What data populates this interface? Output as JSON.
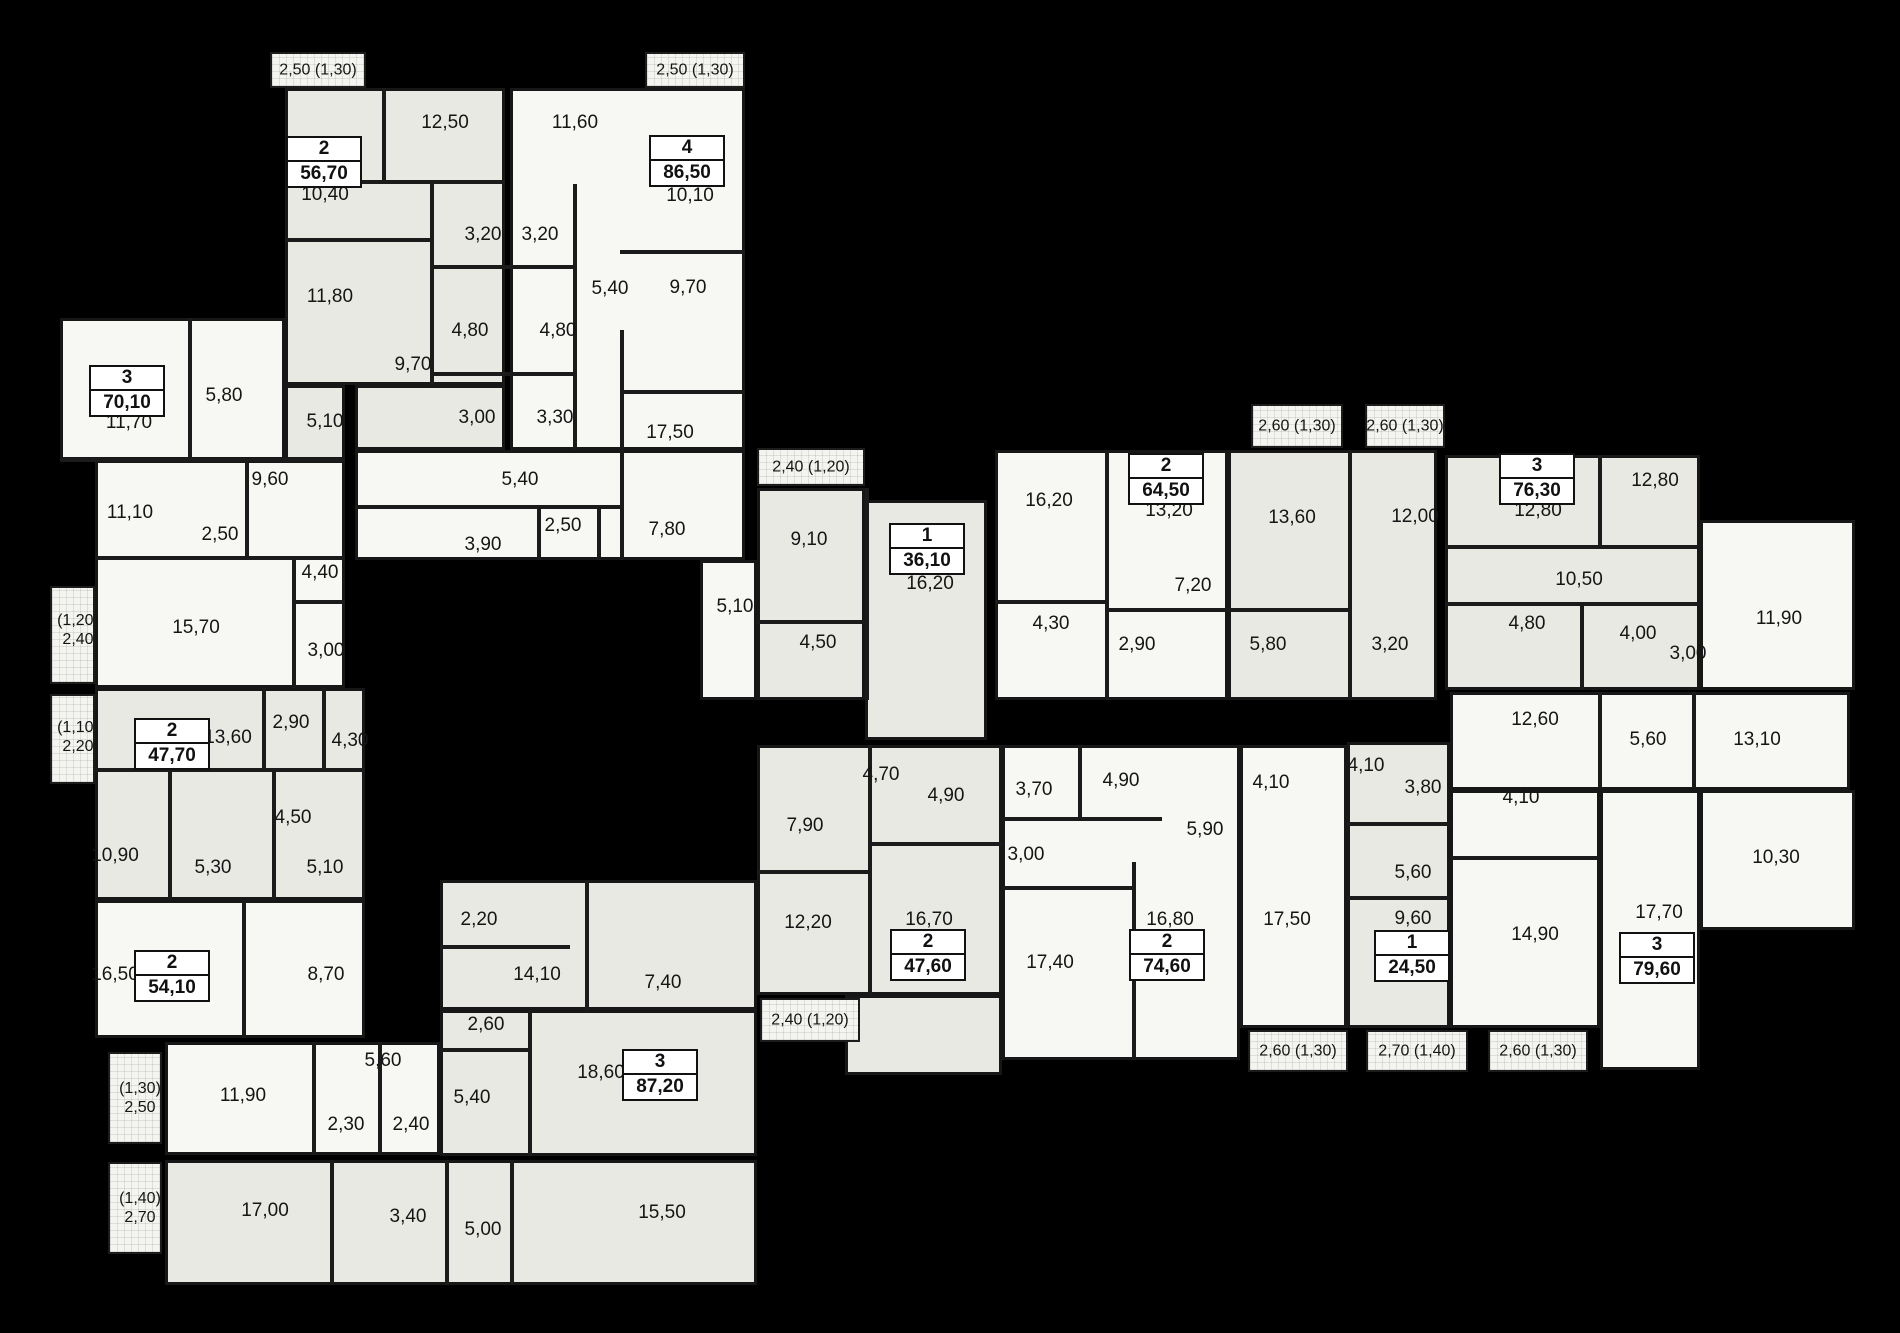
{
  "plan": {
    "background": "#000000",
    "wall_color": "#1b1b1b",
    "tones": {
      "g": "#e9e9e3",
      "w": "#f7f7f3"
    },
    "blocks": [
      {
        "x": 285,
        "y": 88,
        "w": 220,
        "h": 297,
        "t": "g"
      },
      {
        "x": 355,
        "y": 385,
        "w": 150,
        "h": 65,
        "t": "g"
      },
      {
        "x": 510,
        "y": 88,
        "w": 235,
        "h": 362,
        "t": "w"
      },
      {
        "x": 355,
        "y": 450,
        "w": 390,
        "h": 110,
        "t": "w"
      },
      {
        "x": 60,
        "y": 318,
        "w": 225,
        "h": 142,
        "t": "w"
      },
      {
        "x": 285,
        "y": 385,
        "w": 60,
        "h": 75,
        "t": "g"
      },
      {
        "x": 95,
        "y": 460,
        "w": 250,
        "h": 228,
        "t": "w"
      },
      {
        "x": 757,
        "y": 488,
        "w": 108,
        "h": 212,
        "t": "g"
      },
      {
        "x": 865,
        "y": 500,
        "w": 122,
        "h": 240,
        "t": "g"
      },
      {
        "x": 700,
        "y": 560,
        "w": 57,
        "h": 140,
        "t": "w"
      },
      {
        "x": 995,
        "y": 450,
        "w": 233,
        "h": 250,
        "t": "w"
      },
      {
        "x": 1228,
        "y": 450,
        "w": 209,
        "h": 250,
        "t": "g"
      },
      {
        "x": 1445,
        "y": 455,
        "w": 255,
        "h": 235,
        "t": "g"
      },
      {
        "x": 1700,
        "y": 520,
        "w": 155,
        "h": 170,
        "t": "w"
      },
      {
        "x": 1450,
        "y": 692,
        "w": 400,
        "h": 98,
        "t": "w"
      },
      {
        "x": 1450,
        "y": 790,
        "w": 150,
        "h": 238,
        "t": "w"
      },
      {
        "x": 1600,
        "y": 790,
        "w": 100,
        "h": 280,
        "t": "w"
      },
      {
        "x": 1700,
        "y": 790,
        "w": 155,
        "h": 140,
        "t": "w"
      },
      {
        "x": 1347,
        "y": 742,
        "w": 103,
        "h": 286,
        "t": "g"
      },
      {
        "x": 1002,
        "y": 745,
        "w": 238,
        "h": 315,
        "t": "w"
      },
      {
        "x": 1240,
        "y": 745,
        "w": 107,
        "h": 283,
        "t": "w"
      },
      {
        "x": 757,
        "y": 745,
        "w": 245,
        "h": 250,
        "t": "g"
      },
      {
        "x": 845,
        "y": 995,
        "w": 157,
        "h": 80,
        "t": "g"
      },
      {
        "x": 95,
        "y": 688,
        "w": 270,
        "h": 212,
        "t": "g"
      },
      {
        "x": 95,
        "y": 900,
        "w": 270,
        "h": 138,
        "t": "w"
      },
      {
        "x": 165,
        "y": 1042,
        "w": 275,
        "h": 113,
        "t": "w"
      },
      {
        "x": 165,
        "y": 1160,
        "w": 592,
        "h": 125,
        "t": "g"
      },
      {
        "x": 440,
        "y": 880,
        "w": 317,
        "h": 130,
        "t": "g"
      },
      {
        "x": 440,
        "y": 1010,
        "w": 317,
        "h": 146,
        "t": "g"
      }
    ],
    "walls": [
      {
        "x": 382,
        "y": 88,
        "w": 4,
        "h": 94
      },
      {
        "x": 285,
        "y": 238,
        "w": 145,
        "h": 4
      },
      {
        "x": 355,
        "y": 180,
        "w": 150,
        "h": 4
      },
      {
        "x": 430,
        "y": 184,
        "w": 4,
        "h": 201
      },
      {
        "x": 430,
        "y": 265,
        "w": 143,
        "h": 4
      },
      {
        "x": 430,
        "y": 372,
        "w": 143,
        "h": 4
      },
      {
        "x": 573,
        "y": 184,
        "w": 4,
        "h": 266
      },
      {
        "x": 620,
        "y": 250,
        "w": 125,
        "h": 4
      },
      {
        "x": 620,
        "y": 390,
        "w": 125,
        "h": 4
      },
      {
        "x": 620,
        "y": 330,
        "w": 4,
        "h": 230
      },
      {
        "x": 355,
        "y": 505,
        "w": 265,
        "h": 4
      },
      {
        "x": 537,
        "y": 505,
        "w": 4,
        "h": 55
      },
      {
        "x": 597,
        "y": 505,
        "w": 4,
        "h": 55
      },
      {
        "x": 188,
        "y": 318,
        "w": 4,
        "h": 140
      },
      {
        "x": 60,
        "y": 458,
        "w": 285,
        "h": 4
      },
      {
        "x": 95,
        "y": 556,
        "w": 250,
        "h": 4
      },
      {
        "x": 245,
        "y": 460,
        "w": 4,
        "h": 98
      },
      {
        "x": 292,
        "y": 558,
        "w": 4,
        "h": 130
      },
      {
        "x": 292,
        "y": 600,
        "w": 53,
        "h": 4
      },
      {
        "x": 865,
        "y": 488,
        "w": 4,
        "h": 212
      },
      {
        "x": 757,
        "y": 620,
        "w": 108,
        "h": 4
      },
      {
        "x": 1105,
        "y": 450,
        "w": 4,
        "h": 152
      },
      {
        "x": 1348,
        "y": 450,
        "w": 4,
        "h": 250
      },
      {
        "x": 995,
        "y": 600,
        "w": 113,
        "h": 4
      },
      {
        "x": 1105,
        "y": 608,
        "w": 127,
        "h": 4
      },
      {
        "x": 1232,
        "y": 608,
        "w": 120,
        "h": 4
      },
      {
        "x": 1105,
        "y": 600,
        "w": 4,
        "h": 100
      },
      {
        "x": 1598,
        "y": 455,
        "w": 4,
        "h": 92
      },
      {
        "x": 1445,
        "y": 545,
        "w": 255,
        "h": 4
      },
      {
        "x": 1445,
        "y": 602,
        "w": 255,
        "h": 4
      },
      {
        "x": 1580,
        "y": 606,
        "w": 4,
        "h": 84
      },
      {
        "x": 1598,
        "y": 692,
        "w": 4,
        "h": 96
      },
      {
        "x": 1692,
        "y": 692,
        "w": 4,
        "h": 96
      },
      {
        "x": 1450,
        "y": 856,
        "w": 150,
        "h": 4
      },
      {
        "x": 1347,
        "y": 822,
        "w": 103,
        "h": 4
      },
      {
        "x": 1347,
        "y": 896,
        "w": 103,
        "h": 4
      },
      {
        "x": 1078,
        "y": 745,
        "w": 4,
        "h": 74
      },
      {
        "x": 1002,
        "y": 817,
        "w": 160,
        "h": 4
      },
      {
        "x": 1002,
        "y": 886,
        "w": 130,
        "h": 4
      },
      {
        "x": 1132,
        "y": 862,
        "w": 4,
        "h": 198
      },
      {
        "x": 868,
        "y": 745,
        "w": 4,
        "h": 250
      },
      {
        "x": 757,
        "y": 870,
        "w": 113,
        "h": 4
      },
      {
        "x": 870,
        "y": 842,
        "w": 132,
        "h": 4
      },
      {
        "x": 95,
        "y": 768,
        "w": 270,
        "h": 4
      },
      {
        "x": 262,
        "y": 688,
        "w": 4,
        "h": 82
      },
      {
        "x": 322,
        "y": 688,
        "w": 4,
        "h": 82
      },
      {
        "x": 168,
        "y": 770,
        "w": 4,
        "h": 130
      },
      {
        "x": 272,
        "y": 770,
        "w": 4,
        "h": 130
      },
      {
        "x": 242,
        "y": 900,
        "w": 4,
        "h": 138
      },
      {
        "x": 312,
        "y": 1042,
        "w": 4,
        "h": 113
      },
      {
        "x": 378,
        "y": 1042,
        "w": 4,
        "h": 113
      },
      {
        "x": 330,
        "y": 1160,
        "w": 4,
        "h": 125
      },
      {
        "x": 445,
        "y": 1160,
        "w": 4,
        "h": 125
      },
      {
        "x": 510,
        "y": 1160,
        "w": 4,
        "h": 125
      },
      {
        "x": 440,
        "y": 945,
        "w": 130,
        "h": 4
      },
      {
        "x": 585,
        "y": 880,
        "w": 4,
        "h": 132
      },
      {
        "x": 528,
        "y": 1010,
        "w": 4,
        "h": 146
      },
      {
        "x": 440,
        "y": 1048,
        "w": 90,
        "h": 4
      }
    ],
    "balconies": [
      {
        "x": 270,
        "y": 52,
        "w": 96,
        "h": 36
      },
      {
        "x": 645,
        "y": 52,
        "w": 100,
        "h": 36
      },
      {
        "x": 757,
        "y": 448,
        "w": 108,
        "h": 38
      },
      {
        "x": 1251,
        "y": 404,
        "w": 92,
        "h": 44
      },
      {
        "x": 1365,
        "y": 404,
        "w": 80,
        "h": 44
      },
      {
        "x": 50,
        "y": 586,
        "w": 45,
        "h": 98
      },
      {
        "x": 50,
        "y": 694,
        "w": 45,
        "h": 90
      },
      {
        "x": 760,
        "y": 998,
        "w": 100,
        "h": 44
      },
      {
        "x": 1248,
        "y": 1030,
        "w": 100,
        "h": 42
      },
      {
        "x": 1366,
        "y": 1030,
        "w": 102,
        "h": 42
      },
      {
        "x": 1488,
        "y": 1030,
        "w": 100,
        "h": 42
      },
      {
        "x": 108,
        "y": 1052,
        "w": 54,
        "h": 92
      },
      {
        "x": 108,
        "y": 1162,
        "w": 54,
        "h": 92
      }
    ],
    "balcony_labels": [
      {
        "t": "2,50 (1,30)",
        "x": 318,
        "y": 70
      },
      {
        "t": "2,50 (1,30)",
        "x": 695,
        "y": 70
      },
      {
        "t": "2,40 (1,20)",
        "x": 811,
        "y": 467
      },
      {
        "t": "2,60 (1,30)",
        "x": 1297,
        "y": 426
      },
      {
        "t": "2,60 (1,30)",
        "x": 1405,
        "y": 426
      },
      {
        "t": "(1,20)\n2,40",
        "x": 78,
        "y": 630
      },
      {
        "t": "(1,10)\n2,20",
        "x": 78,
        "y": 737
      },
      {
        "t": "2,40 (1,20)",
        "x": 810,
        "y": 1020
      },
      {
        "t": "2,60 (1,30)",
        "x": 1298,
        "y": 1051
      },
      {
        "t": "2,70 (1,40)",
        "x": 1417,
        "y": 1051
      },
      {
        "t": "2,60 (1,30)",
        "x": 1538,
        "y": 1051
      },
      {
        "t": "(1,30)\n2,50",
        "x": 140,
        "y": 1098
      },
      {
        "t": "(1,40)\n2,70",
        "x": 140,
        "y": 1208
      }
    ],
    "room_labels": [
      {
        "t": "12,50",
        "x": 445,
        "y": 123
      },
      {
        "t": "11,60",
        "x": 575,
        "y": 123
      },
      {
        "t": "10,40",
        "x": 325,
        "y": 195
      },
      {
        "t": "10,10",
        "x": 690,
        "y": 196
      },
      {
        "t": "3,20",
        "x": 483,
        "y": 235
      },
      {
        "t": "3,20",
        "x": 540,
        "y": 235
      },
      {
        "t": "5,40",
        "x": 610,
        "y": 289
      },
      {
        "t": "9,70",
        "x": 688,
        "y": 288
      },
      {
        "t": "11,80",
        "x": 330,
        "y": 297
      },
      {
        "t": "4,80",
        "x": 470,
        "y": 331
      },
      {
        "t": "4,80",
        "x": 558,
        "y": 331
      },
      {
        "t": "9,70",
        "x": 413,
        "y": 365
      },
      {
        "t": "3,00",
        "x": 477,
        "y": 418
      },
      {
        "t": "3,30",
        "x": 555,
        "y": 418
      },
      {
        "t": "17,50",
        "x": 670,
        "y": 433
      },
      {
        "t": "5,40",
        "x": 520,
        "y": 480
      },
      {
        "t": "2,50",
        "x": 563,
        "y": 526
      },
      {
        "t": "3,90",
        "x": 483,
        "y": 545
      },
      {
        "t": "7,80",
        "x": 667,
        "y": 530
      },
      {
        "t": "5,80",
        "x": 224,
        "y": 396
      },
      {
        "t": "5,10",
        "x": 325,
        "y": 422
      },
      {
        "t": "11,70",
        "x": 129,
        "y": 423
      },
      {
        "t": "9,60",
        "x": 270,
        "y": 480
      },
      {
        "t": "11,10",
        "x": 130,
        "y": 513
      },
      {
        "t": "2,50",
        "x": 220,
        "y": 535
      },
      {
        "t": "4,40",
        "x": 320,
        "y": 573
      },
      {
        "t": "15,70",
        "x": 196,
        "y": 628
      },
      {
        "t": "3,00",
        "x": 326,
        "y": 651
      },
      {
        "t": "9,10",
        "x": 809,
        "y": 540
      },
      {
        "t": "16,20",
        "x": 930,
        "y": 584
      },
      {
        "t": "5,10",
        "x": 735,
        "y": 607
      },
      {
        "t": "4,50",
        "x": 818,
        "y": 643
      },
      {
        "t": "16,20",
        "x": 1049,
        "y": 501
      },
      {
        "t": "13,20",
        "x": 1169,
        "y": 511
      },
      {
        "t": "13,60",
        "x": 1292,
        "y": 518
      },
      {
        "t": "12,00",
        "x": 1415,
        "y": 517
      },
      {
        "t": "7,20",
        "x": 1193,
        "y": 586
      },
      {
        "t": "4,30",
        "x": 1051,
        "y": 624
      },
      {
        "t": "2,90",
        "x": 1137,
        "y": 645
      },
      {
        "t": "5,80",
        "x": 1268,
        "y": 645
      },
      {
        "t": "3,20",
        "x": 1390,
        "y": 645
      },
      {
        "t": "12,80",
        "x": 1538,
        "y": 511
      },
      {
        "t": "12,80",
        "x": 1655,
        "y": 481
      },
      {
        "t": "10,50",
        "x": 1579,
        "y": 580
      },
      {
        "t": "11,90",
        "x": 1779,
        "y": 619
      },
      {
        "t": "4,80",
        "x": 1527,
        "y": 624
      },
      {
        "t": "4,00",
        "x": 1638,
        "y": 634
      },
      {
        "t": "3,00",
        "x": 1688,
        "y": 654
      },
      {
        "t": "12,60",
        "x": 1535,
        "y": 720
      },
      {
        "t": "5,60",
        "x": 1648,
        "y": 740
      },
      {
        "t": "13,10",
        "x": 1757,
        "y": 740
      },
      {
        "t": "4,10",
        "x": 1521,
        "y": 798
      },
      {
        "t": "10,30",
        "x": 1776,
        "y": 858
      },
      {
        "t": "17,70",
        "x": 1659,
        "y": 913
      },
      {
        "t": "14,90",
        "x": 1535,
        "y": 935
      },
      {
        "t": "4,10",
        "x": 1366,
        "y": 766
      },
      {
        "t": "3,80",
        "x": 1423,
        "y": 788
      },
      {
        "t": "5,60",
        "x": 1413,
        "y": 873
      },
      {
        "t": "9,60",
        "x": 1413,
        "y": 919
      },
      {
        "t": "4,10",
        "x": 1271,
        "y": 783
      },
      {
        "t": "3,70",
        "x": 1034,
        "y": 790
      },
      {
        "t": "4,90",
        "x": 1121,
        "y": 781
      },
      {
        "t": "5,90",
        "x": 1205,
        "y": 830
      },
      {
        "t": "3,00",
        "x": 1026,
        "y": 855
      },
      {
        "t": "16,80",
        "x": 1170,
        "y": 920
      },
      {
        "t": "17,50",
        "x": 1287,
        "y": 920
      },
      {
        "t": "17,40",
        "x": 1050,
        "y": 963
      },
      {
        "t": "4,70",
        "x": 881,
        "y": 775
      },
      {
        "t": "4,90",
        "x": 946,
        "y": 796
      },
      {
        "t": "7,90",
        "x": 805,
        "y": 826
      },
      {
        "t": "12,20",
        "x": 808,
        "y": 923
      },
      {
        "t": "16,70",
        "x": 929,
        "y": 920
      },
      {
        "t": "2,90",
        "x": 291,
        "y": 723
      },
      {
        "t": "13,60",
        "x": 228,
        "y": 738
      },
      {
        "t": "4,30",
        "x": 350,
        "y": 741
      },
      {
        "t": "4,50",
        "x": 293,
        "y": 818
      },
      {
        "t": "10,90",
        "x": 115,
        "y": 856
      },
      {
        "t": "5,30",
        "x": 213,
        "y": 868
      },
      {
        "t": "5,10",
        "x": 325,
        "y": 868
      },
      {
        "t": "16,50",
        "x": 115,
        "y": 975
      },
      {
        "t": "8,70",
        "x": 326,
        "y": 975
      },
      {
        "t": "2,20",
        "x": 479,
        "y": 920
      },
      {
        "t": "14,10",
        "x": 537,
        "y": 975
      },
      {
        "t": "7,40",
        "x": 663,
        "y": 983
      },
      {
        "t": "2,60",
        "x": 486,
        "y": 1025
      },
      {
        "t": "5,60",
        "x": 383,
        "y": 1061
      },
      {
        "t": "18,60",
        "x": 601,
        "y": 1073
      },
      {
        "t": "5,40",
        "x": 472,
        "y": 1098
      },
      {
        "t": "11,90",
        "x": 243,
        "y": 1096
      },
      {
        "t": "2,30",
        "x": 346,
        "y": 1125
      },
      {
        "t": "2,40",
        "x": 411,
        "y": 1125
      },
      {
        "t": "17,00",
        "x": 265,
        "y": 1211
      },
      {
        "t": "3,40",
        "x": 408,
        "y": 1217
      },
      {
        "t": "5,00",
        "x": 483,
        "y": 1230
      },
      {
        "t": "15,50",
        "x": 662,
        "y": 1213
      }
    ],
    "apartments": [
      {
        "rooms": "2",
        "area": "56,70",
        "x": 324,
        "y": 162
      },
      {
        "rooms": "4",
        "area": "86,50",
        "x": 687,
        "y": 161
      },
      {
        "rooms": "3",
        "area": "70,10",
        "x": 127,
        "y": 391
      },
      {
        "rooms": "1",
        "area": "36,10",
        "x": 927,
        "y": 549
      },
      {
        "rooms": "2",
        "area": "64,50",
        "x": 1166,
        "y": 479
      },
      {
        "rooms": "3",
        "area": "76,30",
        "x": 1537,
        "y": 479
      },
      {
        "rooms": "2",
        "area": "47,70",
        "x": 172,
        "y": 744
      },
      {
        "rooms": "2",
        "area": "54,10",
        "x": 172,
        "y": 976
      },
      {
        "rooms": "2",
        "area": "47,60",
        "x": 928,
        "y": 955
      },
      {
        "rooms": "2",
        "area": "74,60",
        "x": 1167,
        "y": 955
      },
      {
        "rooms": "1",
        "area": "24,50",
        "x": 1412,
        "y": 956
      },
      {
        "rooms": "3",
        "area": "79,60",
        "x": 1657,
        "y": 958
      },
      {
        "rooms": "3",
        "area": "87,20",
        "x": 660,
        "y": 1075
      }
    ]
  }
}
